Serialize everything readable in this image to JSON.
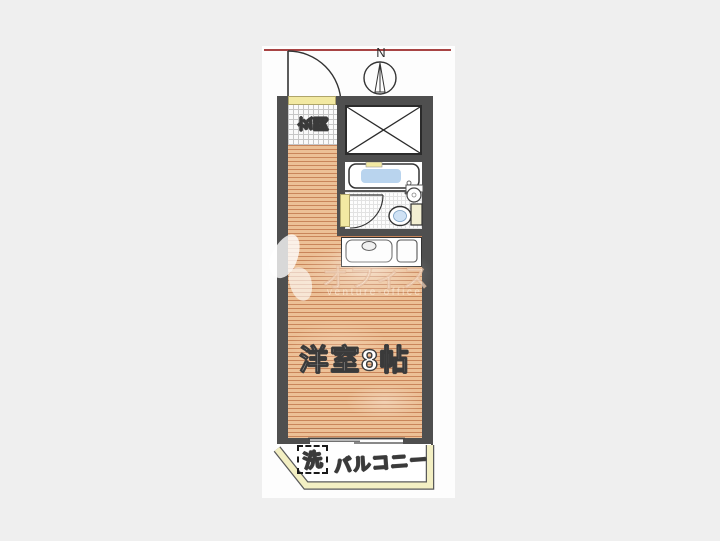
{
  "plan": {
    "compass_label": "N",
    "entrance_label": "玄関",
    "room_label": "洋室8帖",
    "balcony_label": "バルコニー",
    "washer_label": "洗"
  },
  "watermark": {
    "text": "オフィス",
    "subtext": "venture-office"
  },
  "colors": {
    "background": "#efefef",
    "wall": "#4f4f4f",
    "wood_base": "#ecc096",
    "wood_stripe": "#c9855a",
    "accent_yellow": "#f2e9a2",
    "balcony_rail": "#f3efc3",
    "water_blue": "#b9d4ee",
    "red_line": "#a84444"
  }
}
